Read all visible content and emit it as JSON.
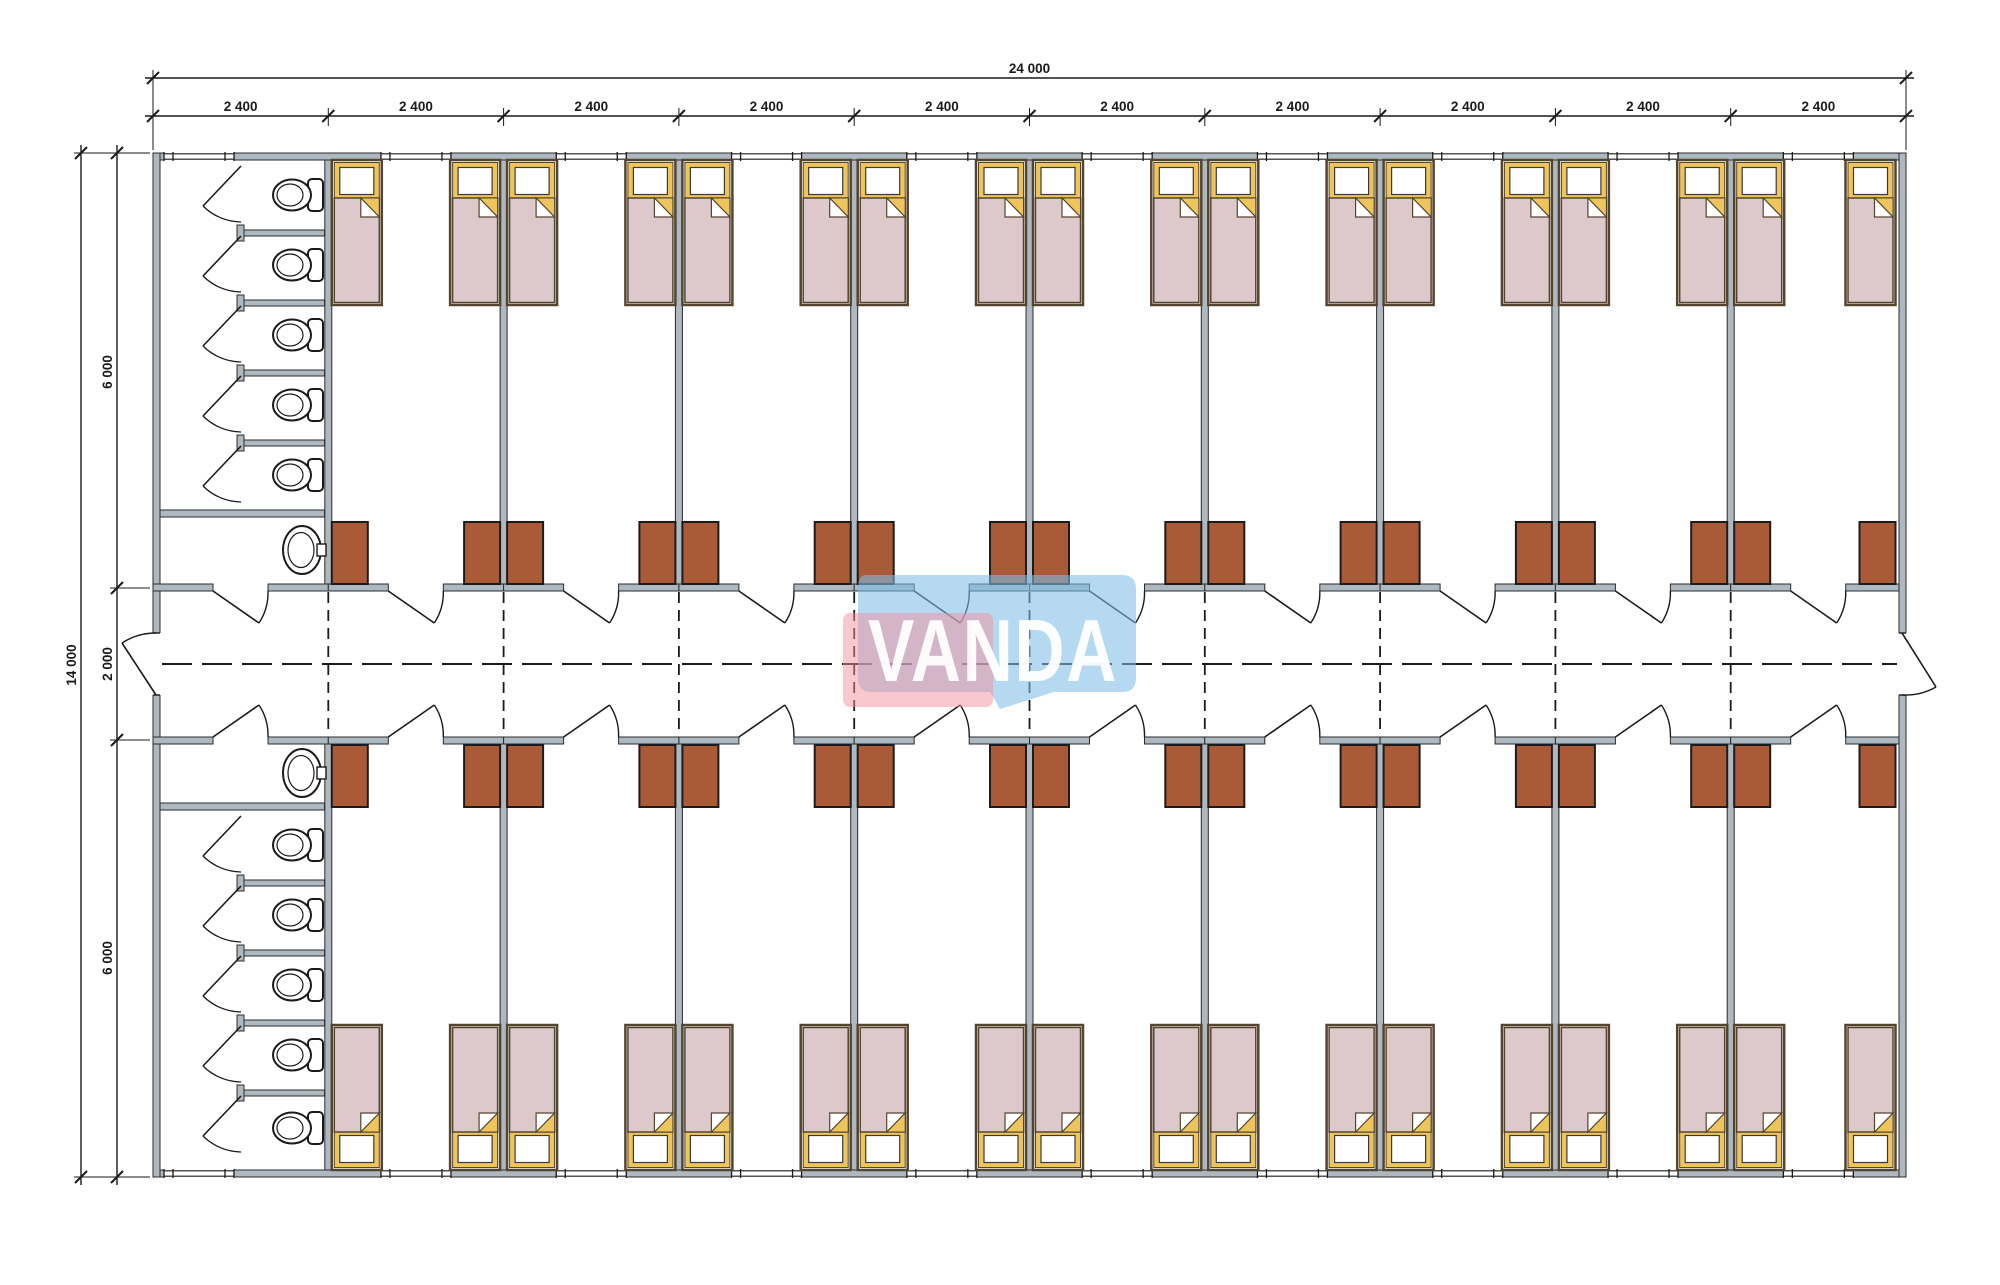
{
  "watermark": {
    "text": "VANDA"
  },
  "dimensions": {
    "overall_width": "24 000",
    "top_segments": [
      "2 400",
      "2 400",
      "2 400",
      "2 400",
      "2 400",
      "2 400",
      "2 400",
      "2 400",
      "2 400",
      "2 400"
    ],
    "overall_height": "14 000",
    "left_top": "6 000",
    "left_middle": "2 000",
    "left_bottom": "6 000"
  },
  "plan": {
    "modules": 10,
    "beds": 36,
    "toilet_stalls": 10,
    "washbasins": 2,
    "wardrobes": 36,
    "windows": 20
  },
  "colors": {
    "wall": "#adb8c0",
    "wall-edge": "#2b2b2b",
    "line": "#1a1a1a",
    "bed-edge": "#54452f",
    "bed-yellow": "#eec45c",
    "blanket": "#ddc9cb",
    "wardrobe": "#ab5a38",
    "wardrobe-edge": "#1c1c1c",
    "logo-pink": "rgba(242,145,158,0.5)",
    "logo-blue": "rgba(125,190,230,0.58)",
    "logo-text": "rgba(255,255,255,0.95)"
  }
}
